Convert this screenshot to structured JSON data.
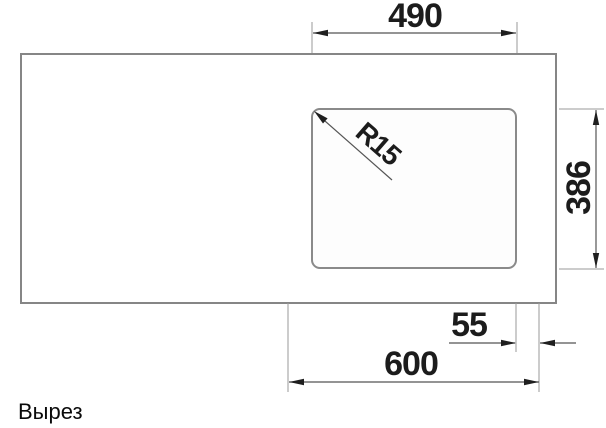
{
  "drawing": {
    "caption": "Вырез",
    "labels": {
      "cutout_width": "490",
      "corner_radius": "R15",
      "cutout_height": "386",
      "edge_offset": "55",
      "cabinet_width": "600"
    },
    "colors": {
      "outline_gray": "#868686",
      "extension_line": "#9a9a9a",
      "dimension_line": "#555555",
      "arrow_and_text": "#1c1c1c",
      "background": "#ffffff"
    }
  }
}
